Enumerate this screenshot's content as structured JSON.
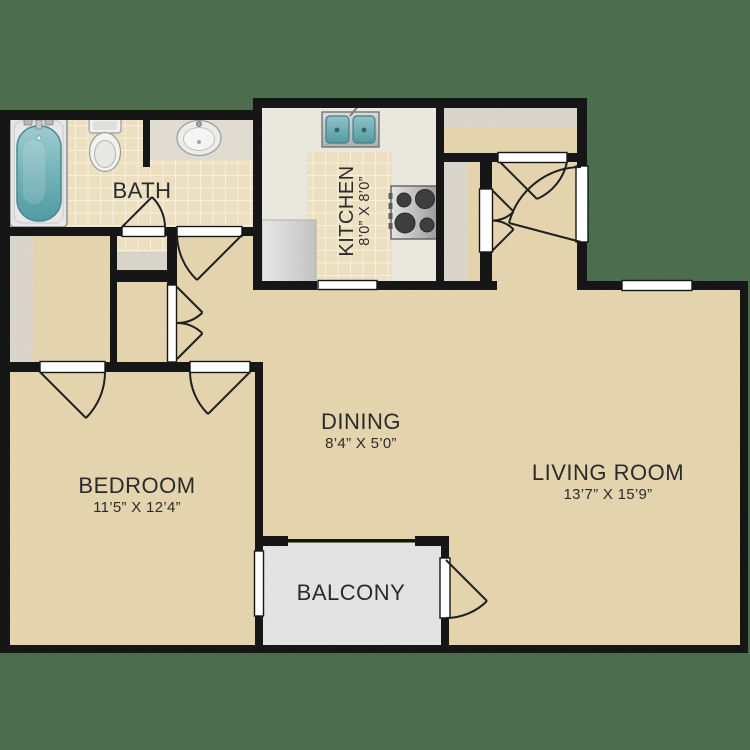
{
  "rooms": {
    "bath": {
      "label": "BATH"
    },
    "kitchen": {
      "label": "KITCHEN",
      "dimensions": "8’0” X 8’0”"
    },
    "dining": {
      "label": "DINING",
      "dimensions": "8’4” X 5’0”"
    },
    "living_room": {
      "label": "LIVING ROOM",
      "dimensions": "13’7” X 15’9”"
    },
    "bedroom": {
      "label": "BEDROOM",
      "dimensions": "11’5” X 12’4”"
    },
    "balcony": {
      "label": "BALCONY"
    }
  },
  "fixtures": [
    "bathtub",
    "toilet",
    "bathroom-sink",
    "kitchen-double-sink",
    "stove",
    "kitchen-counter",
    "closet-shelves"
  ],
  "colors": {
    "background_green": "#4a6b4c",
    "wall_black": "#161616",
    "floor_tan": "#e5d5ae",
    "tile_beige": "#eee1c1",
    "tile_grout": "#f9f2df",
    "kitchen_vinyl": "#ebe9df",
    "balcony_gray": "#e4e4e4",
    "shelf_gray": "#dad6cd",
    "fixture_teal": "#5aa3aa",
    "opening_white": "#ffffff",
    "text_dark": "#2b2b2b"
  }
}
